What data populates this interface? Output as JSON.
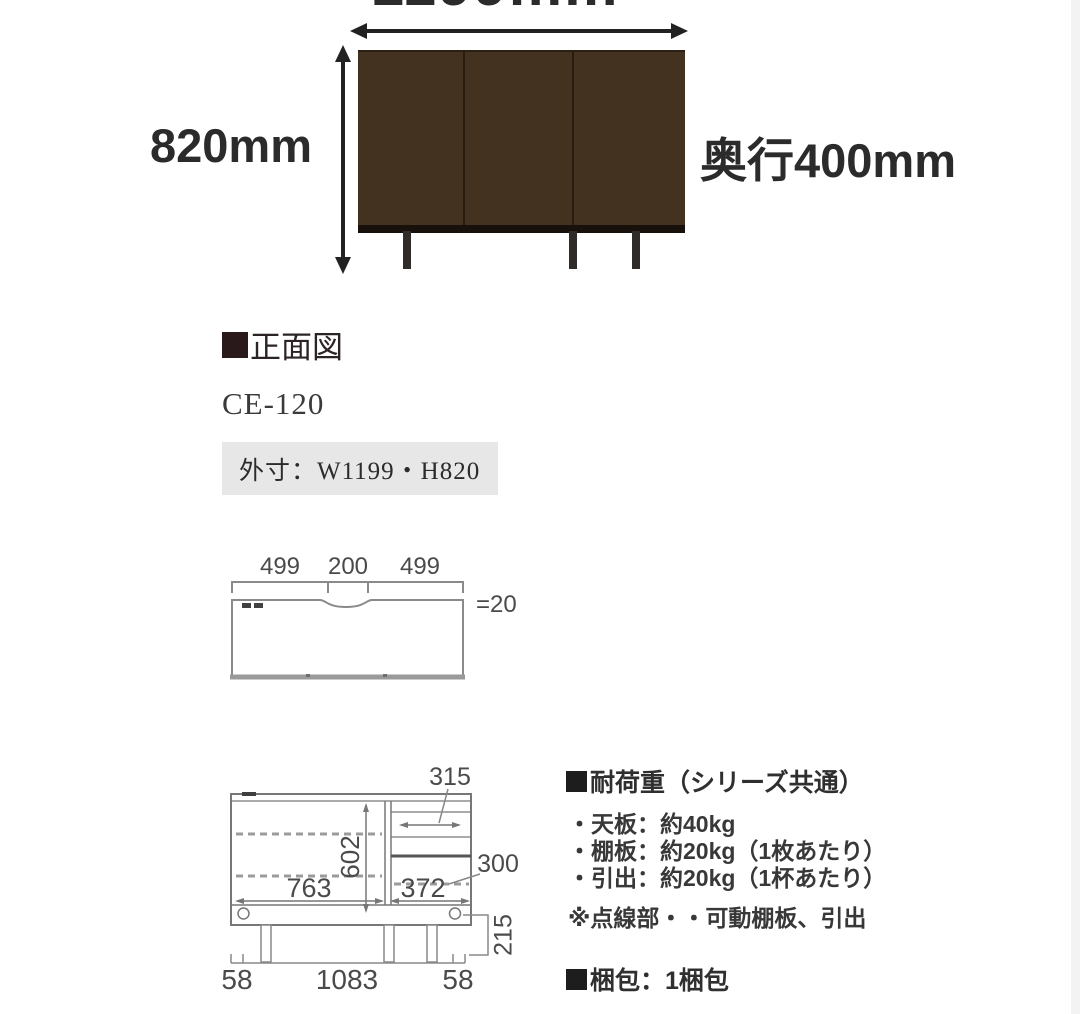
{
  "photo": {
    "width_label": "1199mm",
    "height_label": "820mm",
    "depth_label": "奥行400mm"
  },
  "section": {
    "title": "正面図",
    "model": "CE-120",
    "outer_dims": "外寸：W1199・H820"
  },
  "top_view": {
    "dim_left": "499",
    "dim_center": "200",
    "dim_right": "499",
    "thickness": "=20"
  },
  "front_view": {
    "drawer_width": "315",
    "inner_height": "602",
    "left_inner_width": "763",
    "right_inner_width": "372",
    "shelf_dim": "300",
    "left_offset": "58",
    "base_width": "1083",
    "right_offset": "58",
    "leg_height": "215"
  },
  "specs": {
    "load_title": "耐荷重（シリーズ共通）",
    "load_items": [
      "・天板：約40kg",
      "・棚板：約20kg（1枚あたり）",
      "・引出：約20kg（1杯あたり）"
    ],
    "note": "※点線部・・可動棚板、引出",
    "packing": "梱包：1梱包"
  },
  "colors": {
    "wood": "#43321f",
    "line_gray": "#888888",
    "box_gray": "#e7e7e7",
    "text_dark": "#2b2b2b"
  }
}
